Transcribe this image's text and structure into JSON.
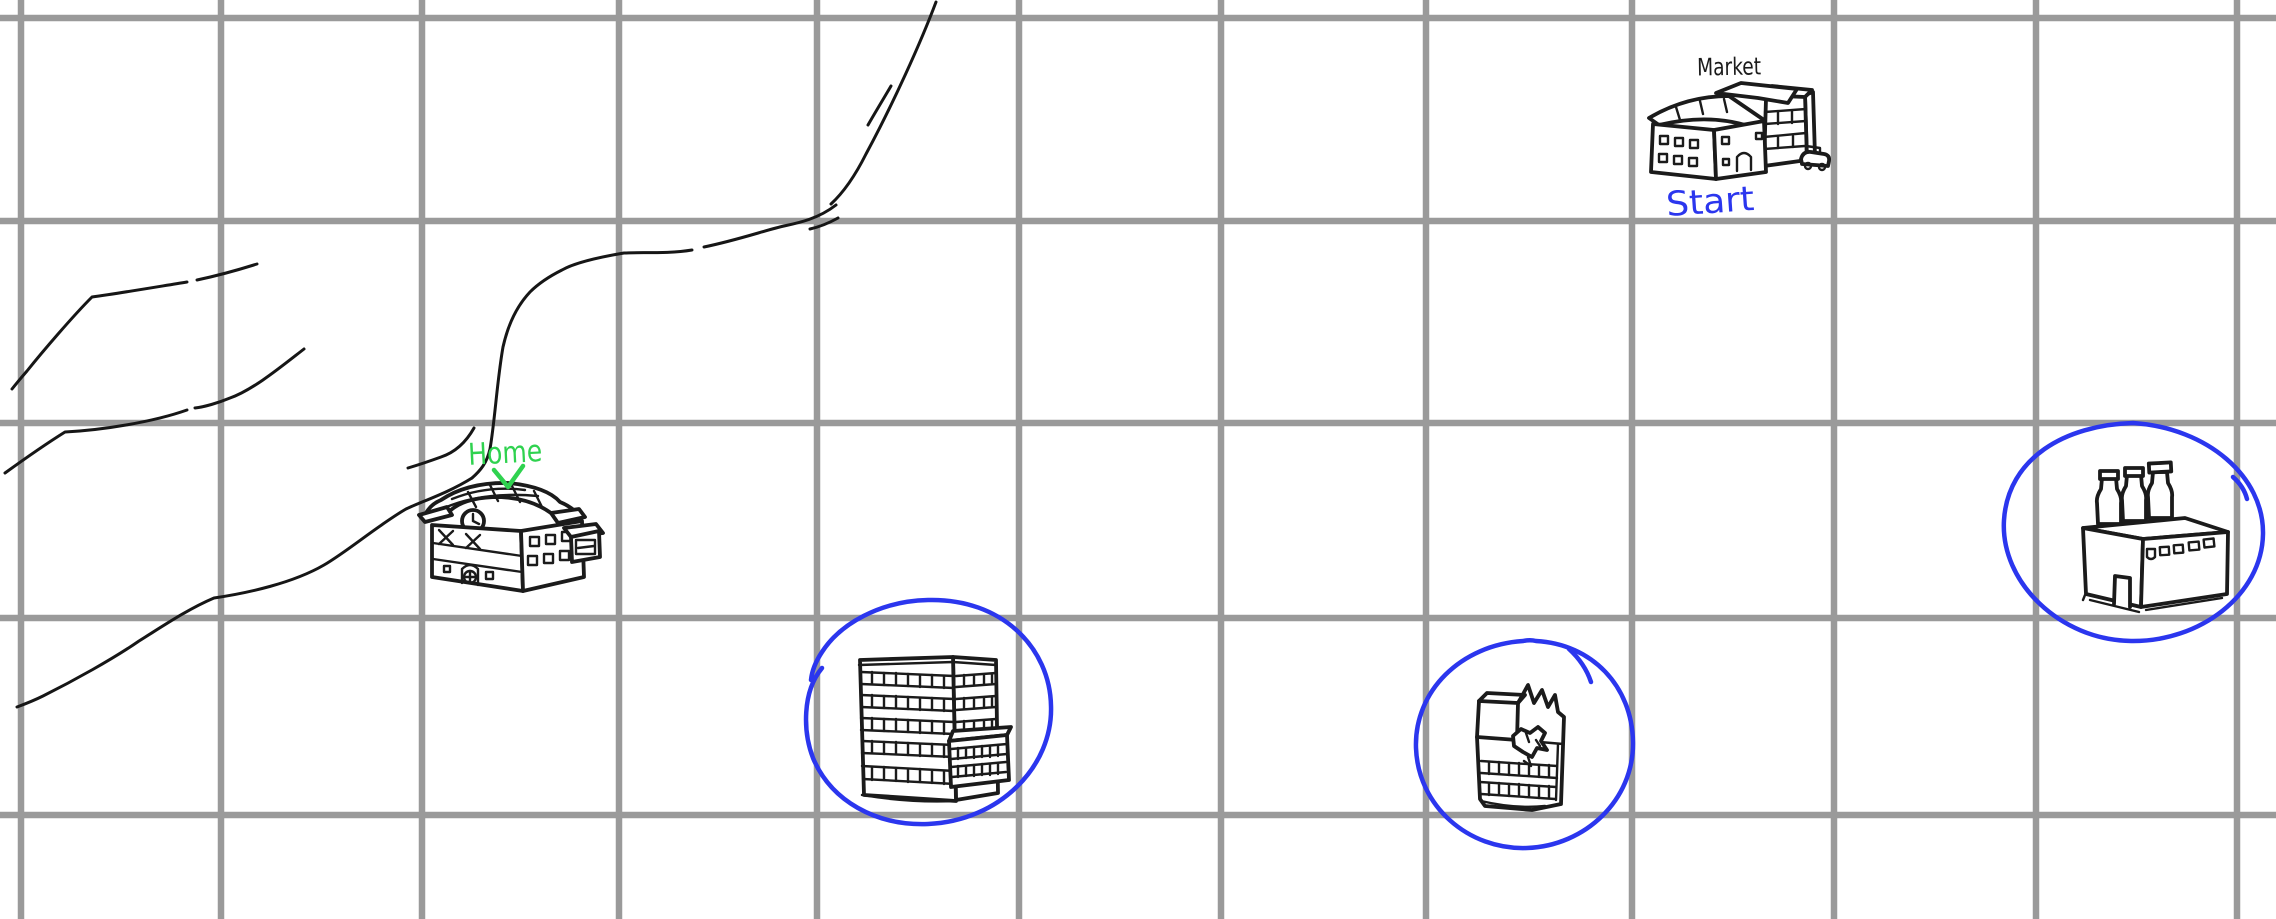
{
  "canvas": {
    "background": "#ffffff",
    "width_px": 2276,
    "height_px": 919
  },
  "grid": {
    "color": "#9a9a9a",
    "columns": 12,
    "rows": 5,
    "cell_size_px": 200,
    "stroke_px": 6.5
  },
  "ink": {
    "sketch_black": "#1b1b1b",
    "pen_blue": "#2b36ee",
    "pen_green": "#2fd24f"
  },
  "labels": {
    "market": "Market",
    "start": "Start",
    "home": "Home"
  },
  "landmarks": [
    {
      "icon": "market-building-icon",
      "label": "Market",
      "sublabel": "Start",
      "circled": false
    },
    {
      "icon": "home-building-icon",
      "label": "Home",
      "marker": "green-check",
      "circled": false
    },
    {
      "icon": "office-tower-icon",
      "circled": true,
      "circle_color": "#2b36ee"
    },
    {
      "icon": "ruined-building-icon",
      "circled": true,
      "circle_color": "#2b36ee"
    },
    {
      "icon": "bottle-factory-icon",
      "circled": true,
      "circle_color": "#2b36ee"
    }
  ],
  "drawings": {
    "river_style": "freehand-black-double-line",
    "selection_circles": 3
  }
}
